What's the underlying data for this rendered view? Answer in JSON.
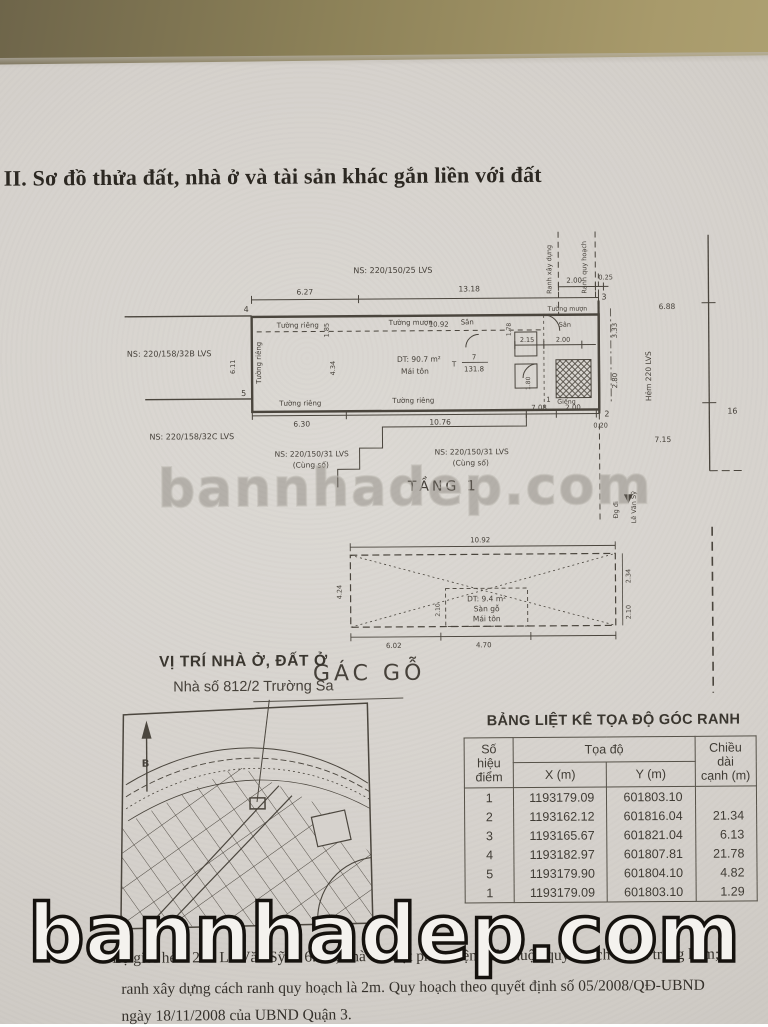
{
  "watermark": {
    "text": "bannhadep.com"
  },
  "title": "II. Sơ đồ thửa đất, nhà ở và tài sản khác gắn liền với đất",
  "floor_plan": {
    "labels": {
      "ns_25": "NS: 220/150/25 LVS",
      "ns_32b": "NS: 220/158/32B LVS",
      "ns_32c": "NS: 220/158/32C LVS",
      "ns_31": "NS: 220/150/31 LVS",
      "cung_so": "(Cùng số)",
      "ranh_xay_dung": "Ranh xây dựng",
      "ranh_quy_hoach": "Ranh quy hoạch",
      "hem": "Hẻm 220 LVS",
      "dg_di": "Đg đi",
      "le_van_sy": "Lê Văn Sỹ",
      "tuong_rieng": "Tường riêng",
      "tuong_muon": "Tường mượn",
      "san": "Sân",
      "gieng": "Giếng",
      "dt": "DT: 90.7 m²",
      "mai_ton": "Mái tôn",
      "parcel_t": "T",
      "parcel_no": "7",
      "parcel_area": "131.8",
      "floor_name": "TẦNG 1"
    },
    "points": {
      "1": "1",
      "2": "2",
      "3": "3",
      "4": "4",
      "5": "5"
    },
    "dims": {
      "627": "6.27",
      "1318": "13.18",
      "200": "2.00",
      "025": "0.25",
      "1092": "10.92",
      "185": "1.85",
      "178": "1.78",
      "215": "2.15",
      "333": "3.33",
      "688": "6.88",
      "280": "2.80",
      "434": "4.34",
      "611": "6.11",
      "630": "6.30",
      "1076": "10.76",
      "708": "7.08",
      "020": "0.20",
      "715": "7.15",
      "16": "16",
      "180": "1.80"
    }
  },
  "gac_go": {
    "label": "GÁC GỖ",
    "dt": "DT: 9.4 m²",
    "san_go": "Sàn gỗ",
    "mai_ton": "Mái tôn",
    "dims": {
      "1092": "10.92",
      "424": "4.24",
      "234": "2.34",
      "210": "2.10",
      "602": "6.02",
      "470": "4.70"
    }
  },
  "location_map": {
    "heading": "VỊ TRÍ NHÀ Ở, ĐẤT Ở",
    "address": "Nhà số 812/2 Trường Sa",
    "north": "B"
  },
  "table": {
    "title": "BẢNG LIỆT KÊ TỌA ĐỘ GÓC RANH",
    "col_point_1": "Số hiệu",
    "col_point_2": "điểm",
    "col_coord": "Tọa độ",
    "col_x": "X (m)",
    "col_y": "Y (m)",
    "col_len_1": "Chiều dài",
    "col_len_2": "cạnh (m)",
    "rows": [
      [
        "1",
        "1193179.09",
        "601803.10",
        ""
      ],
      [
        "2",
        "1193162.12",
        "601816.04",
        "21.34"
      ],
      [
        "3",
        "1193165.67",
        "601821.04",
        "6.13"
      ],
      [
        "4",
        "1193182.97",
        "601807.81",
        "21.78"
      ],
      [
        "5",
        "1193179.90",
        "601804.10",
        "4.82"
      ],
      [
        "1",
        "1193179.09",
        "601803.10",
        "1.29"
      ]
    ]
  },
  "notes": {
    "line1": "- Lộ giới hẻm 220 Lê Văn Sỹ là 6.0m, nhà có một phần diện tích thuộc quy hoạch chỉnh trang hẻm;",
    "line2": "ranh xây dựng cách ranh quy hoạch là 2m. Quy hoạch theo quyết định số 05/2008/QĐ-UBND",
    "line3": "ngày 18/11/2008 của UBND Quận 3."
  }
}
